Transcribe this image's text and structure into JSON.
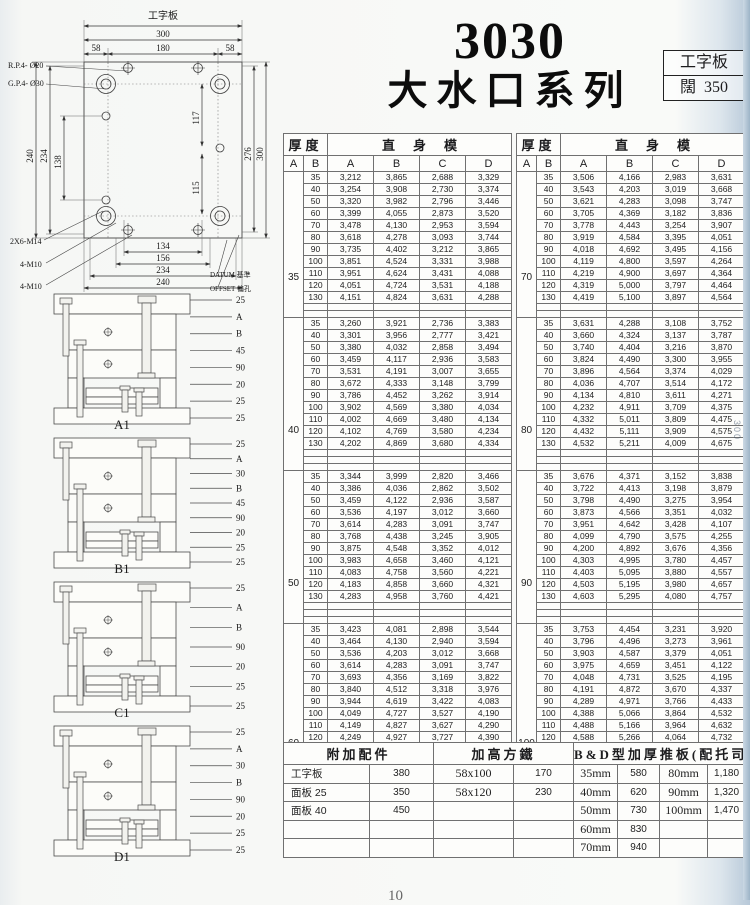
{
  "page_number": "10",
  "title": {
    "model": "3030",
    "series": "大水口系列"
  },
  "corner_box": {
    "line1": "工字板",
    "line2_label": "闊",
    "line2_value": "350"
  },
  "edge": {
    "vertical_text": "300",
    "cut_text_top": ".P",
    "cut_text_bottom": ".P7"
  },
  "plate_drawing": {
    "top_label": "工字板",
    "dim_width_outer": "300",
    "dim_top_segments": [
      "58",
      "180",
      "58"
    ],
    "dim_left": [
      "240",
      "234",
      "138"
    ],
    "dim_right_inner": [
      "117",
      "115"
    ],
    "dim_right_outer": [
      "276",
      "300"
    ],
    "dim_bottom": [
      "134",
      "156",
      "234",
      "240"
    ],
    "callout_rp": "R.P.4- Ø20",
    "callout_gp": "G.P.4- Ø30",
    "callout_m14": "2X6-M14",
    "callout_m10a": "4-M10",
    "callout_m10b": "4-M10",
    "callout_datum": "DATUM 基準",
    "callout_offset": "OFFSET 偏孔"
  },
  "sections": [
    {
      "label": "A1",
      "callouts": [
        "25",
        "A",
        "B",
        "45",
        "90",
        "20",
        "25",
        "25"
      ]
    },
    {
      "label": "B1",
      "callouts": [
        "25",
        "A",
        "30",
        "B",
        "45",
        "90",
        "20",
        "25",
        "25"
      ]
    },
    {
      "label": "C1",
      "callouts": [
        "25",
        "A",
        "B",
        "90",
        "20",
        "25",
        "25"
      ]
    },
    {
      "label": "D1",
      "callouts": [
        "25",
        "A",
        "30",
        "B",
        "90",
        "20",
        "25",
        "25"
      ]
    }
  ],
  "spec_header": {
    "thickness": "厚度",
    "mold": "直身模",
    "cols": [
      "A",
      "B",
      "A",
      "B",
      "C",
      "D"
    ]
  },
  "spec_tables": [
    {
      "blocks": [
        {
          "A": "35",
          "rows": [
            [
              "35",
              "3,212",
              "3,865",
              "2,688",
              "3,329"
            ],
            [
              "40",
              "3,254",
              "3,908",
              "2,730",
              "3,374"
            ],
            [
              "50",
              "3,320",
              "3,982",
              "2,796",
              "3,446"
            ],
            [
              "60",
              "3,399",
              "4,055",
              "2,873",
              "3,520"
            ],
            [
              "70",
              "3,478",
              "4,130",
              "2,953",
              "3,594"
            ],
            [
              "80",
              "3,618",
              "4,278",
              "3,093",
              "3,744"
            ],
            [
              "90",
              "3,735",
              "4,402",
              "3,212",
              "3,865"
            ],
            [
              "100",
              "3,851",
              "4,524",
              "3,331",
              "3,988"
            ],
            [
              "110",
              "3,951",
              "4,624",
              "3,431",
              "4,088"
            ],
            [
              "120",
              "4,051",
              "4,724",
              "3,531",
              "4,188"
            ],
            [
              "130",
              "4,151",
              "4,824",
              "3,631",
              "4,288"
            ]
          ]
        },
        {
          "A": "40",
          "rows": [
            [
              "35",
              "3,260",
              "3,921",
              "2,736",
              "3,383"
            ],
            [
              "40",
              "3,301",
              "3,956",
              "2,777",
              "3,421"
            ],
            [
              "50",
              "3,380",
              "4,032",
              "2,858",
              "3,494"
            ],
            [
              "60",
              "3,459",
              "4,117",
              "2,936",
              "3,583"
            ],
            [
              "70",
              "3,531",
              "4,191",
              "3,007",
              "3,655"
            ],
            [
              "80",
              "3,672",
              "4,333",
              "3,148",
              "3,799"
            ],
            [
              "90",
              "3,786",
              "4,452",
              "3,262",
              "3,914"
            ],
            [
              "100",
              "3,902",
              "4,569",
              "3,380",
              "4,034"
            ],
            [
              "110",
              "4,002",
              "4,669",
              "3,480",
              "4,134"
            ],
            [
              "120",
              "4,102",
              "4,769",
              "3,580",
              "4,234"
            ],
            [
              "130",
              "4,202",
              "4,869",
              "3,680",
              "4,334"
            ]
          ]
        },
        {
          "A": "50",
          "rows": [
            [
              "35",
              "3,344",
              "3,999",
              "2,820",
              "3,466"
            ],
            [
              "40",
              "3,386",
              "4,036",
              "2,862",
              "3,502"
            ],
            [
              "50",
              "3,459",
              "4,122",
              "2,936",
              "3,587"
            ],
            [
              "60",
              "3,536",
              "4,197",
              "3,012",
              "3,660"
            ],
            [
              "70",
              "3,614",
              "4,283",
              "3,091",
              "3,747"
            ],
            [
              "80",
              "3,768",
              "4,438",
              "3,245",
              "3,905"
            ],
            [
              "90",
              "3,875",
              "4,548",
              "3,352",
              "4,012"
            ],
            [
              "100",
              "3,983",
              "4,658",
              "3,460",
              "4,121"
            ],
            [
              "110",
              "4,083",
              "4,758",
              "3,560",
              "4,221"
            ],
            [
              "120",
              "4,183",
              "4,858",
              "3,660",
              "4,321"
            ],
            [
              "130",
              "4,283",
              "4,958",
              "3,760",
              "4,421"
            ]
          ]
        },
        {
          "A": "60",
          "rows": [
            [
              "35",
              "3,423",
              "4,081",
              "2,898",
              "3,544"
            ],
            [
              "40",
              "3,464",
              "4,130",
              "2,940",
              "3,594"
            ],
            [
              "50",
              "3,536",
              "4,203",
              "3,012",
              "3,668"
            ],
            [
              "60",
              "3,614",
              "4,283",
              "3,091",
              "3,747"
            ],
            [
              "70",
              "3,693",
              "4,356",
              "3,169",
              "3,822"
            ],
            [
              "80",
              "3,840",
              "4,512",
              "3,318",
              "3,976"
            ],
            [
              "90",
              "3,944",
              "4,619",
              "3,422",
              "4,083"
            ],
            [
              "100",
              "4,049",
              "4,727",
              "3,527",
              "4,190"
            ],
            [
              "110",
              "4,149",
              "4,827",
              "3,627",
              "4,290"
            ],
            [
              "120",
              "4,249",
              "4,927",
              "3,727",
              "4,390"
            ],
            [
              "130",
              "4,349",
              "5,027",
              "3,827",
              "4,490"
            ]
          ]
        }
      ]
    },
    {
      "blocks": [
        {
          "A": "70",
          "rows": [
            [
              "35",
              "3,506",
              "4,166",
              "2,983",
              "3,631"
            ],
            [
              "40",
              "3,543",
              "4,203",
              "3,019",
              "3,668"
            ],
            [
              "50",
              "3,621",
              "4,283",
              "3,098",
              "3,747"
            ],
            [
              "60",
              "3,705",
              "4,369",
              "3,182",
              "3,836"
            ],
            [
              "70",
              "3,778",
              "4,443",
              "3,254",
              "3,907"
            ],
            [
              "80",
              "3,919",
              "4,584",
              "3,395",
              "4,051"
            ],
            [
              "90",
              "4,018",
              "4,692",
              "3,495",
              "4,156"
            ],
            [
              "100",
              "4,119",
              "4,800",
              "3,597",
              "4,264"
            ],
            [
              "110",
              "4,219",
              "4,900",
              "3,697",
              "4,364"
            ],
            [
              "120",
              "4,319",
              "5,000",
              "3,797",
              "4,464"
            ],
            [
              "130",
              "4,419",
              "5,100",
              "3,897",
              "4,564"
            ]
          ]
        },
        {
          "A": "80",
          "rows": [
            [
              "35",
              "3,631",
              "4,288",
              "3,108",
              "3,752"
            ],
            [
              "40",
              "3,660",
              "4,324",
              "3,137",
              "3,787"
            ],
            [
              "50",
              "3,740",
              "4,404",
              "3,216",
              "3,870"
            ],
            [
              "60",
              "3,824",
              "4,490",
              "3,300",
              "3,955"
            ],
            [
              "70",
              "3,896",
              "4,564",
              "3,374",
              "4,029"
            ],
            [
              "80",
              "4,036",
              "4,707",
              "3,514",
              "4,172"
            ],
            [
              "90",
              "4,134",
              "4,810",
              "3,611",
              "4,271"
            ],
            [
              "100",
              "4,232",
              "4,911",
              "3,709",
              "4,375"
            ],
            [
              "110",
              "4,332",
              "5,011",
              "3,809",
              "4,475"
            ],
            [
              "120",
              "4,432",
              "5,111",
              "3,909",
              "4,575"
            ],
            [
              "130",
              "4,532",
              "5,211",
              "4,009",
              "4,675"
            ]
          ]
        },
        {
          "A": "90",
          "rows": [
            [
              "35",
              "3,676",
              "4,371",
              "3,152",
              "3,838"
            ],
            [
              "40",
              "3,722",
              "4,413",
              "3,198",
              "3,879"
            ],
            [
              "50",
              "3,798",
              "4,490",
              "3,275",
              "3,954"
            ],
            [
              "60",
              "3,873",
              "4,566",
              "3,351",
              "4,032"
            ],
            [
              "70",
              "3,951",
              "4,642",
              "3,428",
              "4,107"
            ],
            [
              "80",
              "4,099",
              "4,790",
              "3,575",
              "4,255"
            ],
            [
              "90",
              "4,200",
              "4,892",
              "3,676",
              "4,356"
            ],
            [
              "100",
              "4,303",
              "4,995",
              "3,780",
              "4,457"
            ],
            [
              "110",
              "4,403",
              "5,095",
              "3,880",
              "4,557"
            ],
            [
              "120",
              "4,503",
              "5,195",
              "3,980",
              "4,657"
            ],
            [
              "130",
              "4,603",
              "5,295",
              "4,080",
              "4,757"
            ]
          ]
        },
        {
          "A": "100",
          "rows": [
            [
              "35",
              "3,753",
              "4,454",
              "3,231",
              "3,920"
            ],
            [
              "40",
              "3,796",
              "4,496",
              "3,273",
              "3,961"
            ],
            [
              "50",
              "3,903",
              "4,587",
              "3,379",
              "4,051"
            ],
            [
              "60",
              "3,975",
              "4,659",
              "3,451",
              "4,122"
            ],
            [
              "70",
              "4,048",
              "4,731",
              "3,525",
              "4,195"
            ],
            [
              "80",
              "4,191",
              "4,872",
              "3,670",
              "4,337"
            ],
            [
              "90",
              "4,289",
              "4,971",
              "3,766",
              "4,433"
            ],
            [
              "100",
              "4,388",
              "5,066",
              "3,864",
              "4,532"
            ],
            [
              "110",
              "4,488",
              "5,166",
              "3,964",
              "4,632"
            ],
            [
              "120",
              "4,588",
              "5,266",
              "4,064",
              "4,732"
            ],
            [
              "130",
              "4,688",
              "5,366",
              "4,164",
              "4,832"
            ]
          ]
        }
      ]
    }
  ],
  "bottom_table": {
    "headers": [
      "附加配件",
      "加高方鐵",
      "B&D型加厚推板(配托司)"
    ],
    "rows": [
      [
        "工字板",
        "380",
        "58x100",
        "170",
        "35mm",
        "580",
        "80mm",
        "1,180"
      ],
      [
        "面板 25",
        "350",
        "58x120",
        "230",
        "40mm",
        "620",
        "90mm",
        "1,320"
      ],
      [
        "面板 40",
        "450",
        "",
        "",
        "50mm",
        "730",
        "100mm",
        "1,470"
      ],
      [
        "",
        "",
        "",
        "",
        "60mm",
        "830",
        "",
        ""
      ],
      [
        "",
        "",
        "",
        "",
        "70mm",
        "940",
        "",
        ""
      ]
    ]
  }
}
